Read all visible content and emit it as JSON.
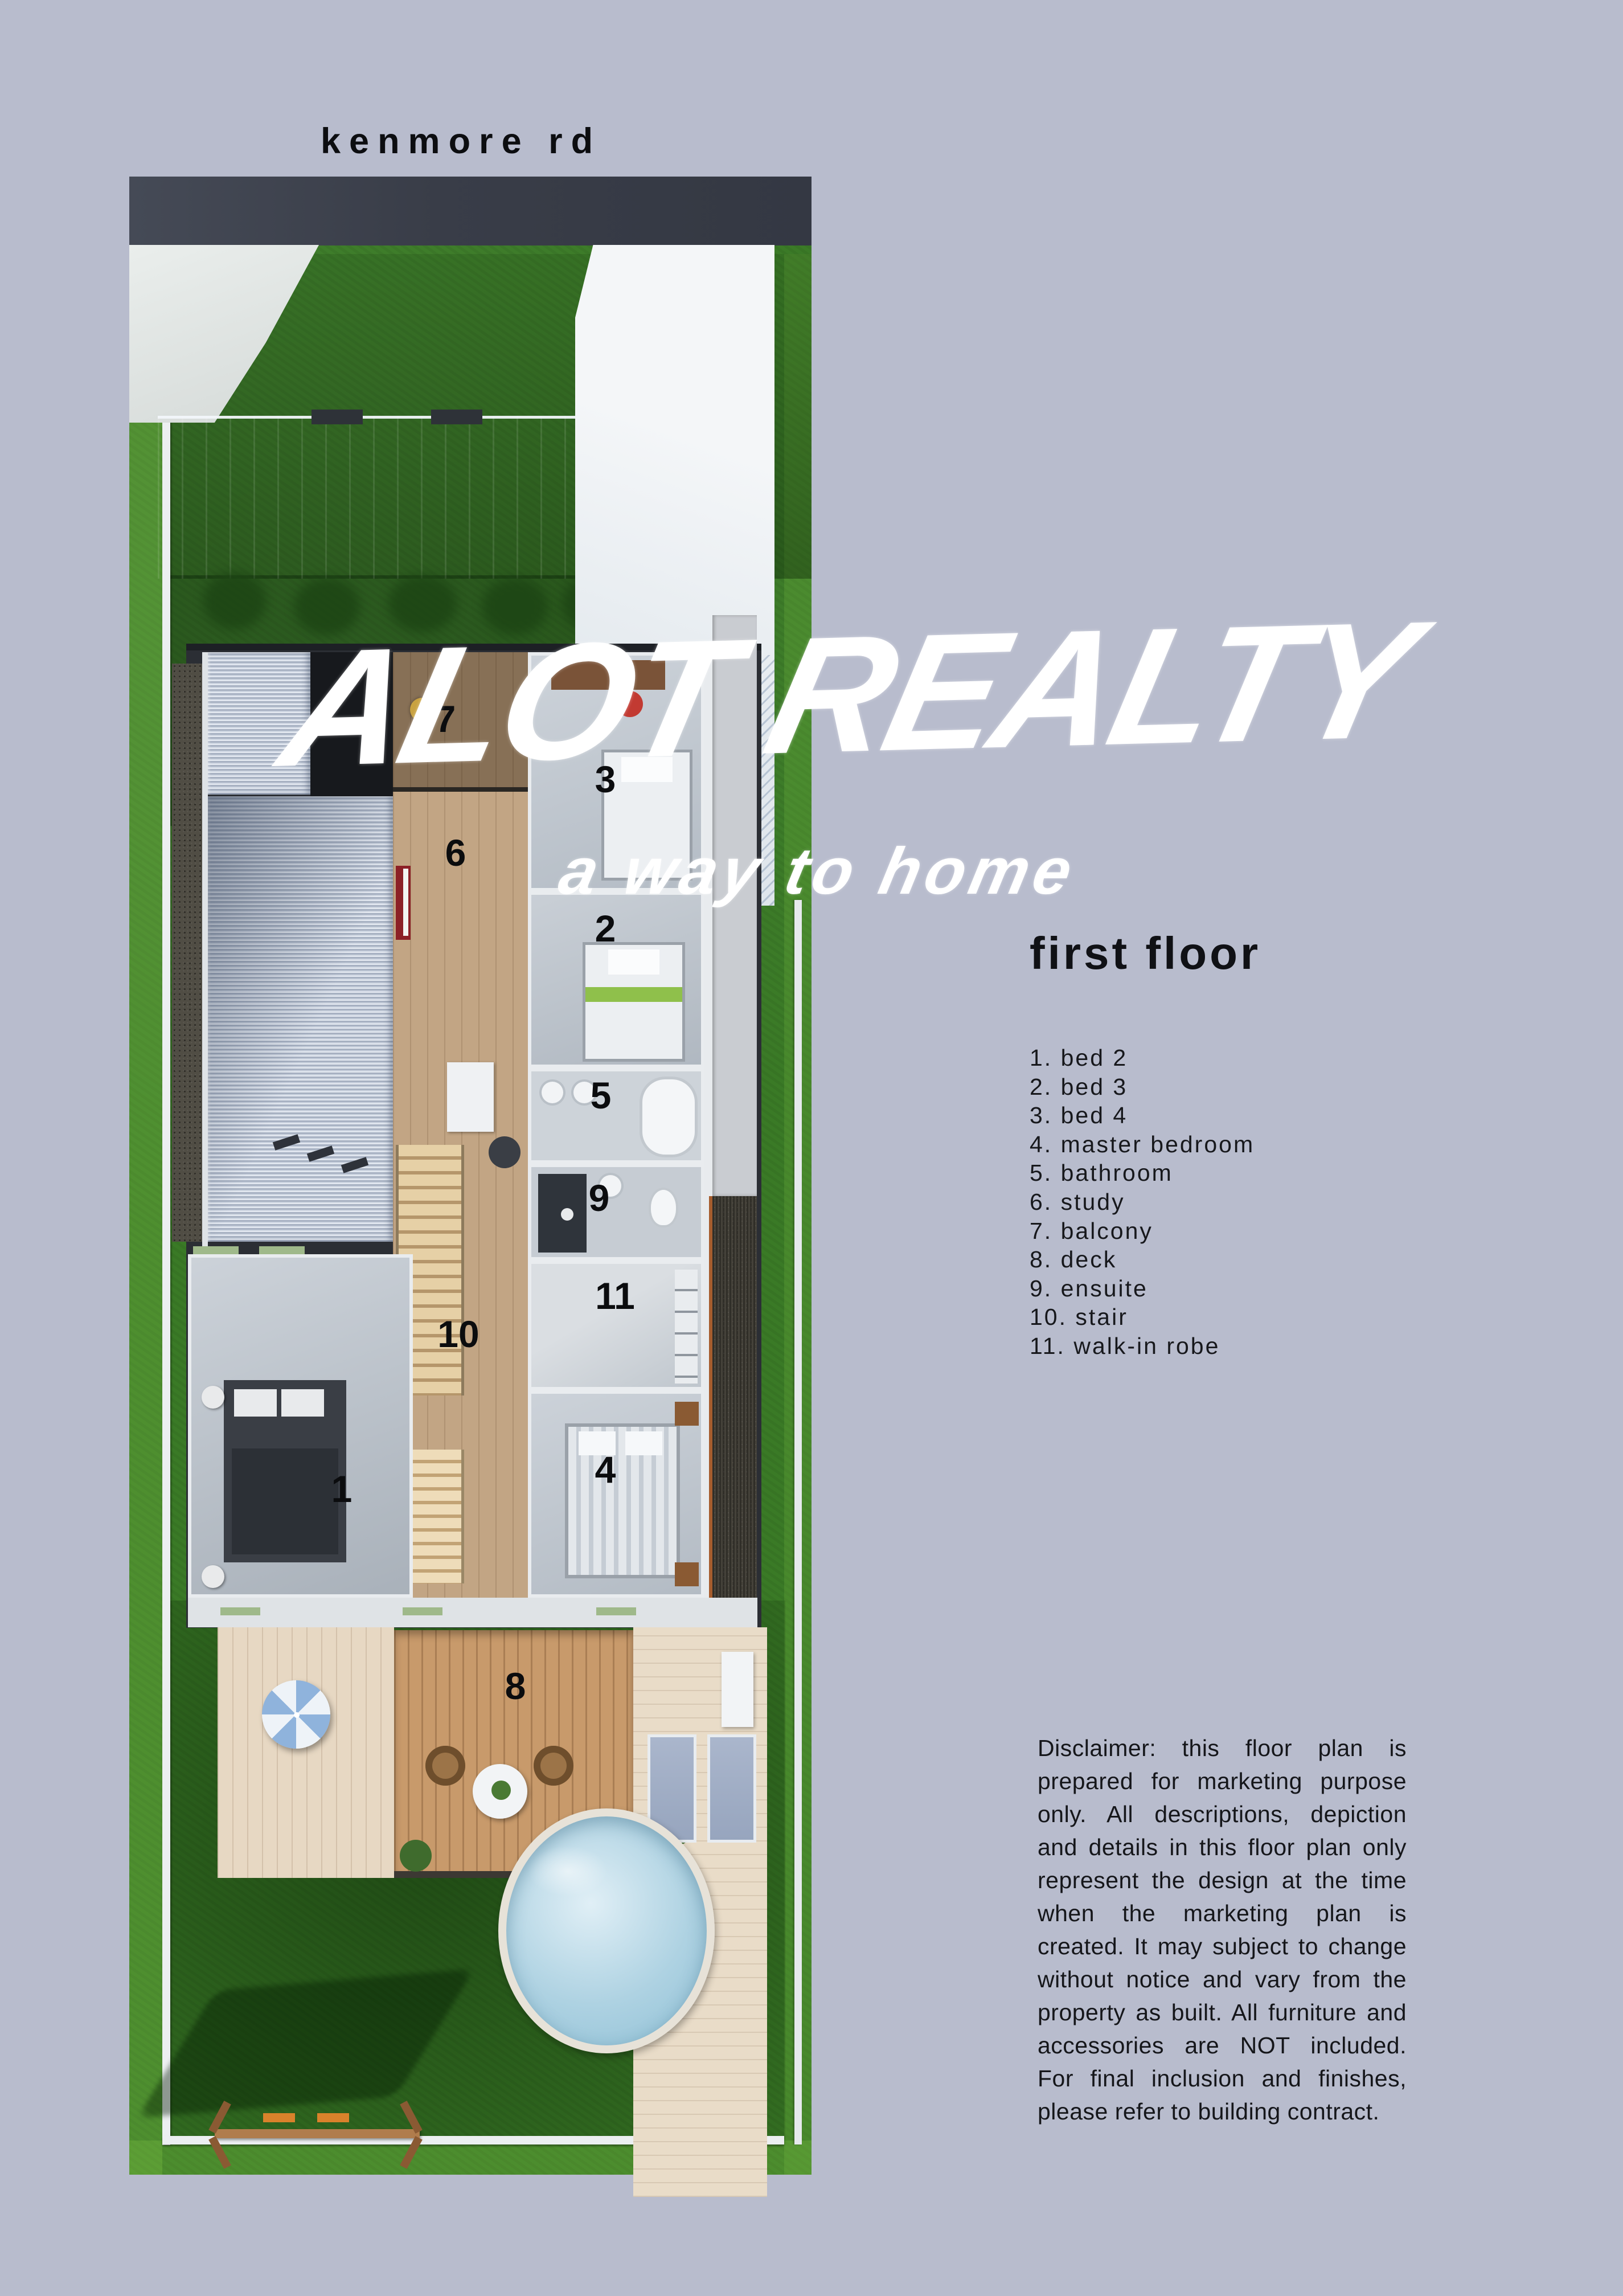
{
  "colors": {
    "background": "#b8bccd",
    "road": "#3c404b",
    "grass": "#3a7a26",
    "roof_white": "#eef1f4",
    "roof_metal": "#c3ccd9",
    "corridor_wood": "#c2a584",
    "deck_wood": "#c89a6b",
    "deck_light": "#e7d8c3",
    "pool_water": "#aed2e2",
    "title_white": "#ffffff",
    "text_dark": "#15161a"
  },
  "header": {
    "street_label": "kenmore rd"
  },
  "brand": {
    "title": "ALOT REALTY",
    "tagline": "a way to home"
  },
  "floor": {
    "heading": "first floor"
  },
  "legend": {
    "items": [
      "1. bed 2",
      "2. bed 3",
      "3. bed 4",
      "4. master bedroom",
      "5. bathroom",
      "6. study",
      "7. balcony",
      "8. deck",
      "9. ensuite",
      "10. stair",
      "11. walk-in robe"
    ]
  },
  "plan": {
    "markers": [
      "1",
      "2",
      "3",
      "4",
      "5",
      "6",
      "7",
      "8",
      "9",
      "10",
      "11"
    ]
  },
  "disclaimer": {
    "text": "Disclaimer: this floor plan is prepared for marketing purpose only. All descriptions, depiction and details in this floor plan only represent the design at the time when the marketing plan is created. It may subject to change without notice and vary from the property as built. All furniture and accessories are NOT included. For final inclusion and finishes, please refer to building contract."
  }
}
